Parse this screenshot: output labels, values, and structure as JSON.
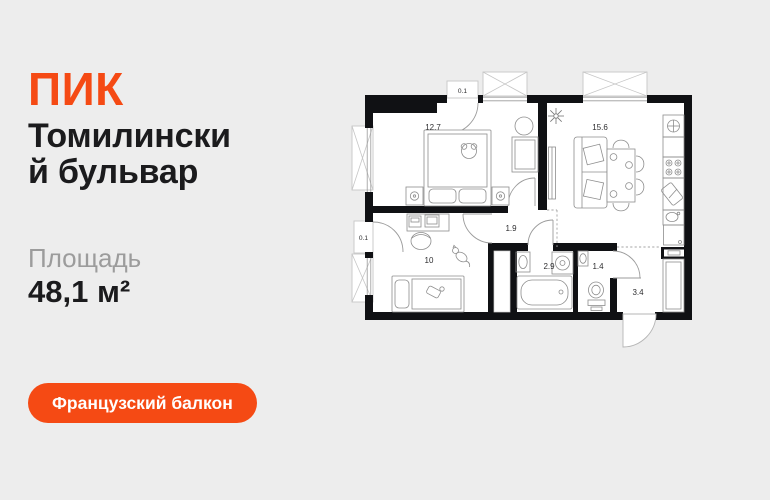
{
  "logo": {
    "text": "ПИК"
  },
  "title": {
    "line1": "Томилински",
    "line2": "й бульвар"
  },
  "area": {
    "label": "Площадь",
    "value": "48,1 м²"
  },
  "badge": {
    "label": "Французский балкон"
  },
  "colors": {
    "accent": "#F54A14",
    "background": "#EDEDED",
    "text_dark": "#1B1B1D",
    "text_gray": "#9C9C9C",
    "wall": "#101114"
  },
  "floor_plan": {
    "rooms": [
      {
        "name": "bedroom",
        "area": "12.7"
      },
      {
        "name": "kitchen-living-room",
        "area": "15.6"
      },
      {
        "name": "hallway",
        "area": "1.9"
      },
      {
        "name": "second-room",
        "area": "10"
      },
      {
        "name": "bathroom",
        "area": "2.9"
      },
      {
        "name": "wc",
        "area": "1.4"
      },
      {
        "name": "entrance-hall",
        "area": "3.4"
      },
      {
        "name": "french-balcony-top",
        "area": "0.1"
      },
      {
        "name": "french-balcony-left",
        "area": "0.1"
      }
    ]
  }
}
